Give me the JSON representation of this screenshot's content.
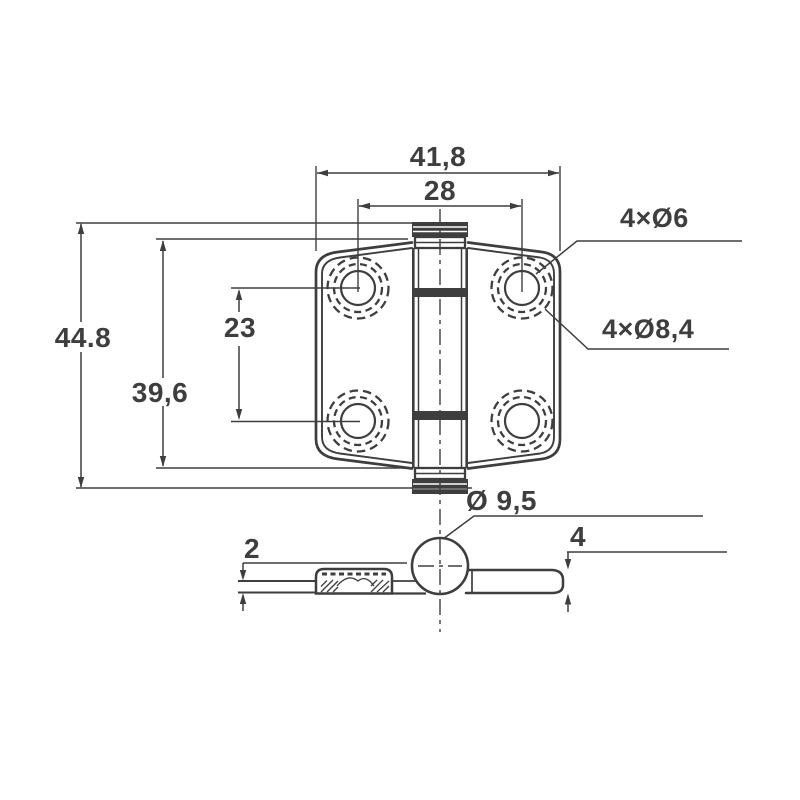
{
  "drawing": {
    "type": "engineering-drawing",
    "subject": "surface-mount hinge, plan view with hole pattern and sectioned side view",
    "colors": {
      "background": "#ffffff",
      "line": "#3e3e3e",
      "text": "#3e3e3e"
    },
    "plan_view": {
      "overall_width": "41,8",
      "hole_spacing_horizontal": "28",
      "overall_height": "44.8",
      "leaf_height": "39,6",
      "hole_spacing_vertical": "23",
      "hole_callout_small": "4×Ø6",
      "hole_callout_large": "4×Ø8,4"
    },
    "section_view": {
      "pin_diameter": "Ø 9,5",
      "left_leaf_thickness": "2",
      "right_leaf_thickness": "4"
    }
  }
}
